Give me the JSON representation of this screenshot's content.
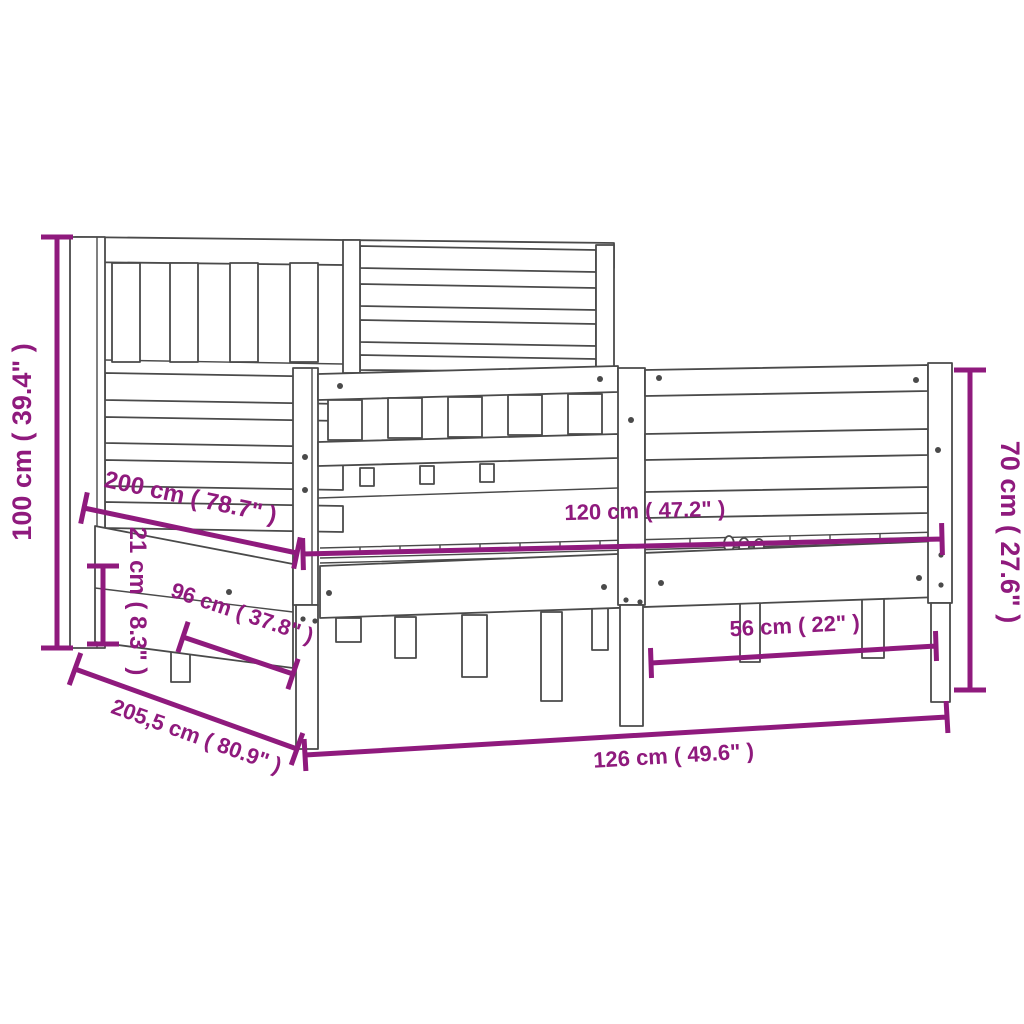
{
  "diagram": {
    "kind": "product-dimension-diagram",
    "subject": "wooden bed frame with headboard and footboard",
    "colors": {
      "dimension_color": "#8f1a7d",
      "line_art_color": "#4a4a4a",
      "background": "#ffffff"
    },
    "dimensions": [
      {
        "id": "headboard-height",
        "label": "100 cm ( 39.4\" )",
        "orientation": "vertical-left"
      },
      {
        "id": "inner-length",
        "label": "200 cm ( 78.7\" )",
        "orientation": "diagonal"
      },
      {
        "id": "inner-width",
        "label": "120 cm ( 47.2\" )",
        "orientation": "horizontal"
      },
      {
        "id": "footboard-height",
        "label": "70 cm ( 27.6\" )",
        "orientation": "vertical-right"
      },
      {
        "id": "side-rail-height",
        "label": "21 cm ( 8.3\" )",
        "orientation": "vertical-small"
      },
      {
        "id": "under-bed-length",
        "label": "96 cm ( 37.8\" )",
        "orientation": "diagonal"
      },
      {
        "id": "under-bed-width",
        "label": "56 cm ( 22\" )",
        "orientation": "horizontal"
      },
      {
        "id": "total-length",
        "label": "205,5 cm ( 80.9\" )",
        "orientation": "diagonal"
      },
      {
        "id": "total-width",
        "label": "126 cm ( 49.6\" )",
        "orientation": "horizontal"
      }
    ]
  }
}
